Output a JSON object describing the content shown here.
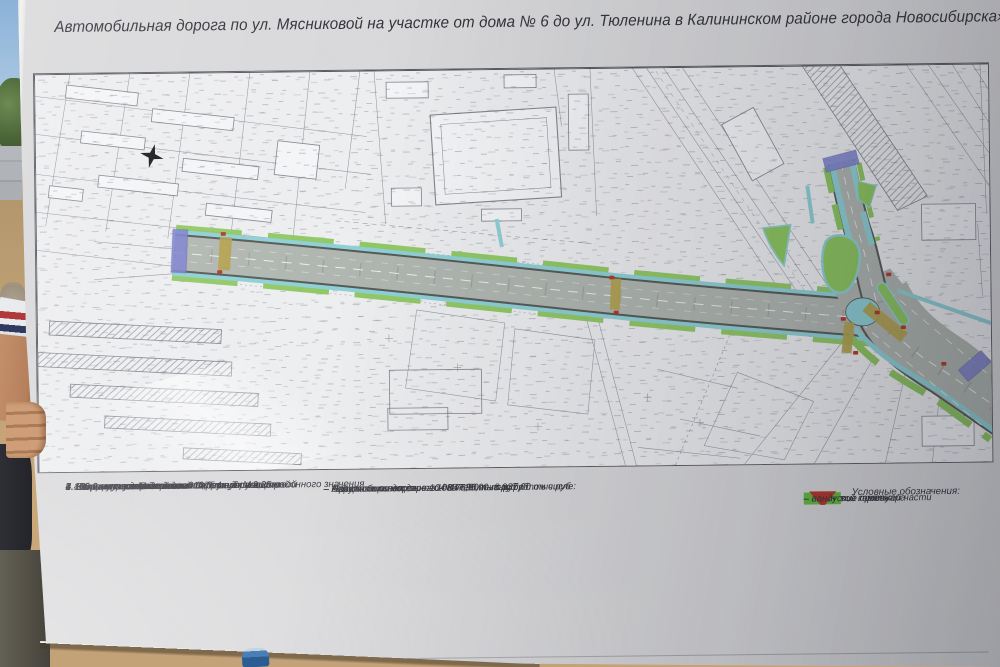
{
  "board": {
    "title": "Автомобильная дорога по ул. Мясниковой на участке от дома № 6 до ул. Тюленина в Калининском районе города Новосибирска»"
  },
  "specs": [
    "1.  Начало участка: от дома №6 по ул. Мясниковой",
    "2.  Конец участка: пересечение с ул. Тюленина",
    "3.  Категория дороги – магистральная улица районного значения",
    "4.  Общая протяженность 610,0 м в том числе:",
    "–  460,0 м по ул. Мясниковой",
    "–  150,0 м по ул. Тюленина",
    "5.  Количество полос движения – 4 шт.",
    "6.  Ширина полосы движения 3,75 м",
    "7.  Ширина пешеходной части тротуара 2,25 м"
  ],
  "costs": [
    "Общая стоимость  – 104 847,00 тыс.руб в том числе:",
    "–  Автомобильная дорога – 85 735,00 тыс.руб",
    "–  Организация дорожного движения – 8 937,00 тыс.руб",
    "–  Наружное освещение – 10 175,00 тыс.руб"
  ],
  "legend": {
    "title": "Условные обозначения:",
    "items": [
      {
        "label": "– бортовой камень",
        "color": "#1b1b1d",
        "shape": "line"
      },
      {
        "label": "– покрытие проезжей части",
        "color": "#c2c8c8",
        "shape": "rect"
      },
      {
        "label": "– покрытие тротуара",
        "color": "#b6dde0",
        "shape": "rect"
      },
      {
        "label": "– газон",
        "color": "#64bb3d",
        "shape": "rect"
      },
      {
        "label": "– пандус",
        "color": "#b5342a",
        "shape": "triangle"
      }
    ]
  },
  "palette": {
    "paper": "#edeef0",
    "line": "#90919b",
    "road": "#b0b6b0",
    "roadedge": "#565b56",
    "sidewalk": "#8fd0d6",
    "lawn": "#8dc65e",
    "crossing": "#b3a24c",
    "marker": "#7e82cd",
    "ramp": "#b4372b",
    "ink": "#33343a"
  }
}
